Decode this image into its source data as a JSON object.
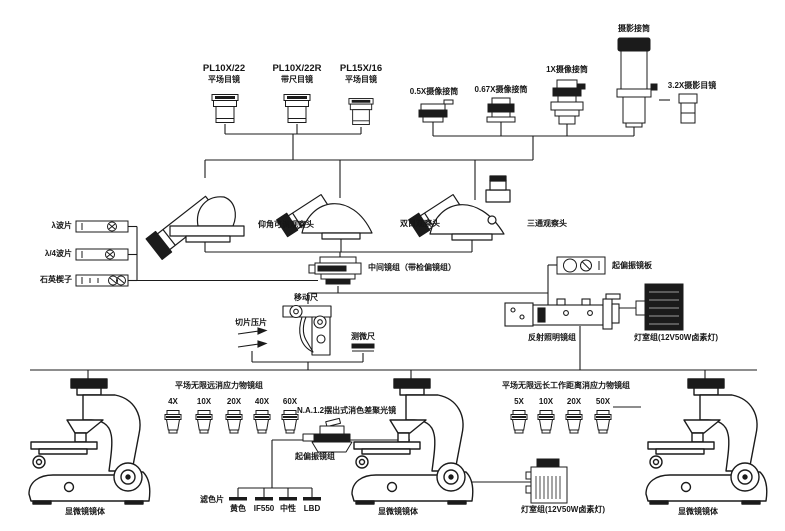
{
  "eyepieces": [
    {
      "model": "PL10X/22",
      "type": "平场目镜"
    },
    {
      "model": "PL10X/22R",
      "type": "带尺目镜"
    },
    {
      "model": "PL15X/16",
      "type": "平场目镜"
    }
  ],
  "camera_adapters": {
    "x05": "0.5X摄像接筒",
    "x067": "0.67X摄像接筒",
    "x1": "1X摄像接筒",
    "photo_tube": "摄影接筒",
    "photo_eyepiece": "3.2X摄影目镜"
  },
  "heads": [
    {
      "label": "仰角可调观察头"
    },
    {
      "label": "双目观察头"
    },
    {
      "label": "三通观察头"
    }
  ],
  "compensators": [
    {
      "label": "λ波片"
    },
    {
      "label": "λ/4波片"
    },
    {
      "label": "石英楔子"
    }
  ],
  "intermediate_tube": {
    "label": "中间镜组（带检偏镜组）"
  },
  "polarizer_plate": {
    "label": "起偏振镜板"
  },
  "reflected_illuminator": {
    "label": "反射照明镜组"
  },
  "lamp_house_right": {
    "label": "灯室组(12V50W卤素灯)"
  },
  "stage_accessories": {
    "stage_ruler": "移动尺",
    "slide_clips": "切片压片",
    "micrometer": "测微尺"
  },
  "objective_group_transmitted": {
    "title": "平场无限远消应力物镜组",
    "magnifications": [
      "4X",
      "10X",
      "20X",
      "40X",
      "60X"
    ]
  },
  "objective_group_long_wd": {
    "title": "平场无限远长工作距离消应力物镜组",
    "magnifications": [
      "5X",
      "10X",
      "20X",
      "50X"
    ]
  },
  "condenser": {
    "label": "N.A.1.2摆出式消色差聚光镜",
    "polarizer_label": "起偏振镜组"
  },
  "filters": {
    "label": "滤色片",
    "options": [
      "黄色",
      "IF550",
      "中性",
      "LBD"
    ]
  },
  "lamp_house_bottom": {
    "label": "灯室组(12V50W卤素灯)"
  },
  "microscope_bodies": [
    {
      "label": "显微镜镜体"
    },
    {
      "label": "显微镜镜体"
    },
    {
      "label": "显微镜镜体"
    }
  ]
}
